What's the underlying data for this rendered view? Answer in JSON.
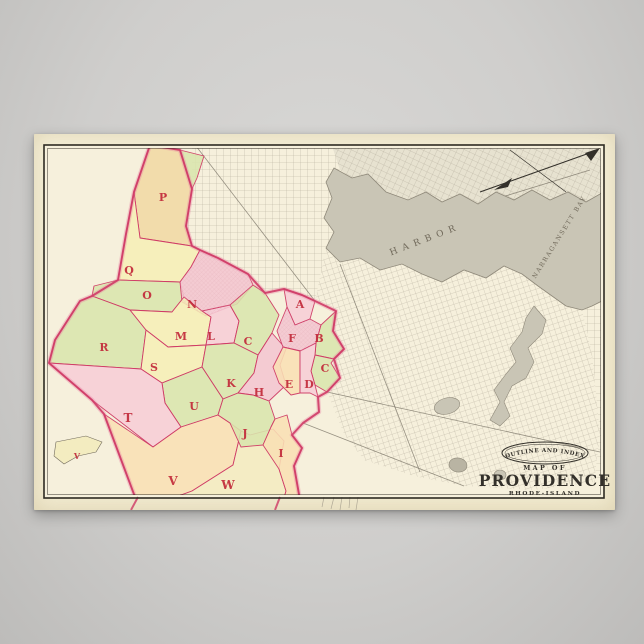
{
  "map": {
    "cartouche": {
      "arc": "OUTLINE AND INDEX",
      "map_of": "MAP OF",
      "city": "PROVIDENCE",
      "state": "RHODE-ISLAND"
    },
    "water_labels": [
      {
        "text": "HARBOR",
        "x": 392,
        "y": 108,
        "rot": -21,
        "size": 9,
        "spacing": 5.5
      },
      {
        "text": "NARRAGANSETT BAY",
        "x": 527,
        "y": 104,
        "rot": -58,
        "size": 6.2,
        "spacing": 1.6
      }
    ],
    "colors": {
      "parchment": "#f6f0dc",
      "frame_ink": "#2e2a22",
      "ink": "#33302a",
      "boundary": "#cf3b66",
      "boundary_glow": "#e87fa0",
      "letter_red": "#c22a3a",
      "water": "#c9c5b5",
      "water_deep": "#b9b4a3",
      "water_edge": "#8f897a",
      "street": "#a59e8d",
      "road": "#6f695c",
      "built": "#dca4ae",
      "label_gray": "#70695a"
    },
    "palette": {
      "tan": "#f1d9a4",
      "yellow": "#f5efb6",
      "green": "#d9e5ad",
      "rose": "#f3c6d0",
      "pink": "#f6cdd6",
      "peach": "#f8dfb4",
      "paleyellow": "#f3ecc0"
    },
    "street_blocks": [
      {
        "pattern": "grid1",
        "points": "158,14 298,12 306,36 292,48 298,64 290,84 300,98 292,114 281,167 268,161 250,155 231,159 214,140 184,124 166,116 158,112 152,92 158,55"
      },
      {
        "pattern": "grid2",
        "tint": "#e7e2d0",
        "points": "298,12 566,14 570,56 552,68 534,58 516,66 498,56 480,66 462,58 444,70 426,60 408,68 392,58 374,66 352,58 334,40 318,44 306,36"
      },
      {
        "pattern": "grid3",
        "points": "292,114 306,128 326,124 346,136 368,130 388,140 408,148 430,136 452,144 470,132 488,140 504,152 518,162 532,172 548,176 558,220 566,300 560,348 500,356 430,352 380,342 330,326 310,300 293,258 306,244 297,229 310,215 299,197 302,177 281,167"
      },
      {
        "pattern": "grid1",
        "points": "570,170 570,350 560,348 566,300 558,220 548,176 558,172"
      }
    ],
    "roads": [
      {
        "x1": 281,
        "y1": 167,
        "x2": 162,
        "y2": 12
      },
      {
        "x1": 296,
        "y1": 116,
        "x2": 556,
        "y2": 36
      },
      {
        "x1": 293,
        "y1": 258,
        "x2": 566,
        "y2": 318
      },
      {
        "x1": 269,
        "y1": 289,
        "x2": 430,
        "y2": 352
      },
      {
        "x1": 306,
        "y1": 130,
        "x2": 386,
        "y2": 338
      }
    ],
    "water": {
      "outline": "300,34 318,44 334,40 352,58 374,66 392,58 408,68 426,60 444,70 462,58 480,66 498,56 516,66 534,58 552,68 566,60 570,56 570,166 558,172 548,176 532,172 518,162 504,152 496,146 488,140 470,132 452,144 430,136 408,148 388,140 368,130 346,136 326,124 306,128 292,114 300,98 290,84 298,64 292,48",
      "river": "500,172 512,186 508,200 494,214 500,228 492,244 478,252 470,268 476,282 466,292 456,286 466,268 460,256 472,240 482,228 476,214 488,198 492,184",
      "ponds": [
        {
          "cx": 413,
          "cy": 272,
          "rx": 13,
          "ry": 8,
          "rot": -15
        },
        {
          "cx": 424,
          "cy": 331,
          "rx": 9,
          "ry": 7,
          "rot": 10,
          "deep": true
        },
        {
          "cx": 466,
          "cy": 341,
          "rx": 6,
          "ry": 5,
          "rot": 0
        }
      ]
    },
    "districts": [
      {
        "letter": "P",
        "color": "tan",
        "points": "116,11 146,16 158,55 152,92 158,112 106,104 100,58"
      },
      {
        "color": "green",
        "points": "146,16 170,22 163,44 158,55"
      },
      {
        "letter": "Q",
        "color": "yellow",
        "points": "100,58 106,104 158,112 166,116 157,133 146,148 84,146 92,100"
      },
      {
        "letter": "O",
        "color": "green",
        "points": "60,152 84,146 146,148 150,163 138,178 96,176 58,162"
      },
      {
        "letter": "N",
        "color": "rose",
        "points": "146,148 157,133 166,116 184,124 214,140 219,151 203,170 172,182 148,168"
      },
      {
        "letter": "R",
        "color": "green",
        "points": "46,167 58,162 96,176 112,196 107,235 15,229 21,206"
      },
      {
        "letter": "M",
        "color": "yellow",
        "points": "138,178 150,163 168,177 177,183 172,211 134,213 112,196 96,176"
      },
      {
        "letter": "L",
        "color": "pink",
        "points": "168,177 196,171 205,187 200,209 172,211 177,183"
      },
      {
        "letter": "C",
        "color": "green",
        "points": "196,171 219,151 231,159 245,181 238,199 224,221 200,209 205,187"
      },
      {
        "letter": "S",
        "color": "yellow",
        "points": "112,196 134,213 172,211 168,233 128,249 107,235"
      },
      {
        "letter": "K",
        "color": "green",
        "points": "172,211 200,209 224,221 220,239 204,259 189,265 168,233"
      },
      {
        "letter": "H",
        "color": "rose",
        "points": "224,221 238,199 252,215 246,231 252,251 235,267 219,261 204,259 220,239"
      },
      {
        "letter": "U",
        "color": "green",
        "points": "128,249 168,233 189,265 184,281 147,293 131,269"
      },
      {
        "letter": "T",
        "color": "pink",
        "points": "15,229 107,235 128,249 131,269 147,293 119,313 58,266"
      },
      {
        "letter": "V",
        "color": "peach",
        "points": "70,280 119,313 147,293 184,281 196,289 207,297 199,331 158,357 120,371 104,371"
      },
      {
        "letter": "W",
        "color": "paleyellow",
        "points": "199,331 207,297 216,301 239,295 250,307 245,335 252,357 248,371 120,371 158,357"
      },
      {
        "letter": "J",
        "color": "green",
        "points": "189,265 204,259 219,261 235,267 241,285 237,293 229,311 207,313 196,289 184,281"
      },
      {
        "letter": "I",
        "color": "peach",
        "points": "241,285 253,281 258,301 268,314 260,332 266,366 248,371 252,357 245,335 229,311 237,293"
      },
      {
        "letter": "A",
        "color": "pink",
        "points": "250,155 268,161 281,167 276,185 261,191 253,173"
      },
      {
        "letter": "F",
        "color": "rose",
        "points": "253,173 261,191 276,185 287,191 282,209 267,217 249,213 243,197"
      },
      {
        "letter": "B",
        "color": "green",
        "points": "287,191 302,177 299,197 310,215 300,225 281,221 282,209"
      },
      {
        "letter": "C",
        "color": "green",
        "points": "281,221 300,225 297,229 306,244 293,258 281,251 277,237"
      },
      {
        "letter": "E",
        "color": "peach",
        "points": "239,233 249,213 266,217 266,259 257,261 245,249"
      },
      {
        "letter": "D",
        "color": "pink",
        "points": "266,217 282,209 281,221 277,237 281,251 284,263 276,259 266,259"
      }
    ],
    "built_overlays": [
      "146,148 157,133 166,116 184,124 214,140 219,151 203,170 172,182 148,168",
      "253,173 261,191 276,185 287,191 282,209 267,217 249,213 243,197"
    ],
    "outer_boundary": "116,11 146,16 158,55 152,92 158,112 166,116 184,124 214,140 231,159 250,155 268,161 281,167 302,177 299,197 310,215 300,225 306,244 293,258 284,263 285,278 269,289 258,301 268,314 260,332 266,366 248,371 120,371 104,371 70,280 58,266 15,229 21,206 46,167 58,162 84,146 92,100 100,58",
    "index_letters": [
      {
        "ch": "P",
        "x": 129,
        "y": 67
      },
      {
        "ch": "Q",
        "x": 95,
        "y": 140
      },
      {
        "ch": "O",
        "x": 113,
        "y": 165
      },
      {
        "ch": "N",
        "x": 158,
        "y": 174
      },
      {
        "ch": "R",
        "x": 70,
        "y": 217
      },
      {
        "ch": "M",
        "x": 147,
        "y": 206
      },
      {
        "ch": "L",
        "x": 177,
        "y": 206
      },
      {
        "ch": "C",
        "x": 214,
        "y": 211
      },
      {
        "ch": "S",
        "x": 120,
        "y": 237
      },
      {
        "ch": "K",
        "x": 197,
        "y": 253
      },
      {
        "ch": "H",
        "x": 225,
        "y": 262
      },
      {
        "ch": "E",
        "x": 255,
        "y": 254
      },
      {
        "ch": "D",
        "x": 275,
        "y": 254
      },
      {
        "ch": "A",
        "x": 266,
        "y": 174
      },
      {
        "ch": "F",
        "x": 258,
        "y": 208
      },
      {
        "ch": "B",
        "x": 285,
        "y": 208
      },
      {
        "ch": "C",
        "x": 291,
        "y": 238
      },
      {
        "ch": "T",
        "x": 94,
        "y": 288,
        "s": 12
      },
      {
        "ch": "U",
        "x": 160,
        "y": 276
      },
      {
        "ch": "J",
        "x": 211,
        "y": 303
      },
      {
        "ch": "I",
        "x": 247,
        "y": 323
      },
      {
        "ch": "V",
        "x": 139,
        "y": 351,
        "s": 12
      },
      {
        "ch": "W",
        "x": 194,
        "y": 355,
        "s": 12
      },
      {
        "ch": "V",
        "x": 43,
        "y": 325,
        "s": 8,
        "island": true
      }
    ],
    "island": {
      "points": "22,308 52,302 68,308 62,318 44,322 30,330 20,322"
    },
    "north_arrow": {
      "main": {
        "x1": 446,
        "y1": 58,
        "x2": 564,
        "y2": 16
      },
      "cross": {
        "x1": 476,
        "y1": 16,
        "x2": 532,
        "y2": 58
      },
      "head": "566,14 551,19 557,27",
      "feather": "460,56 478,44 474,53"
    },
    "fine_print": {
      "x1": 96,
      "y1": 366,
      "x2": 262,
      "y2": 366
    },
    "bleeds": {
      "red": [
        {
          "x1": 104,
          "y1": 363,
          "x2": 97,
          "y2": 376
        },
        {
          "x1": 246,
          "y1": 363,
          "x2": 241,
          "y2": 376
        }
      ],
      "gray": [
        {
          "x1": 290,
          "y1": 363,
          "x2": 288,
          "y2": 373
        },
        {
          "x1": 300,
          "y1": 363,
          "x2": 297,
          "y2": 375
        },
        {
          "x1": 308,
          "y1": 363,
          "x2": 306,
          "y2": 376
        },
        {
          "x1": 316,
          "y1": 363,
          "x2": 315,
          "y2": 374
        },
        {
          "x1": 324,
          "y1": 363,
          "x2": 322,
          "y2": 376
        }
      ]
    },
    "frame": {
      "outer": [
        10,
        11,
        560,
        353
      ],
      "inner": [
        13.5,
        14.5,
        553,
        346
      ]
    }
  }
}
